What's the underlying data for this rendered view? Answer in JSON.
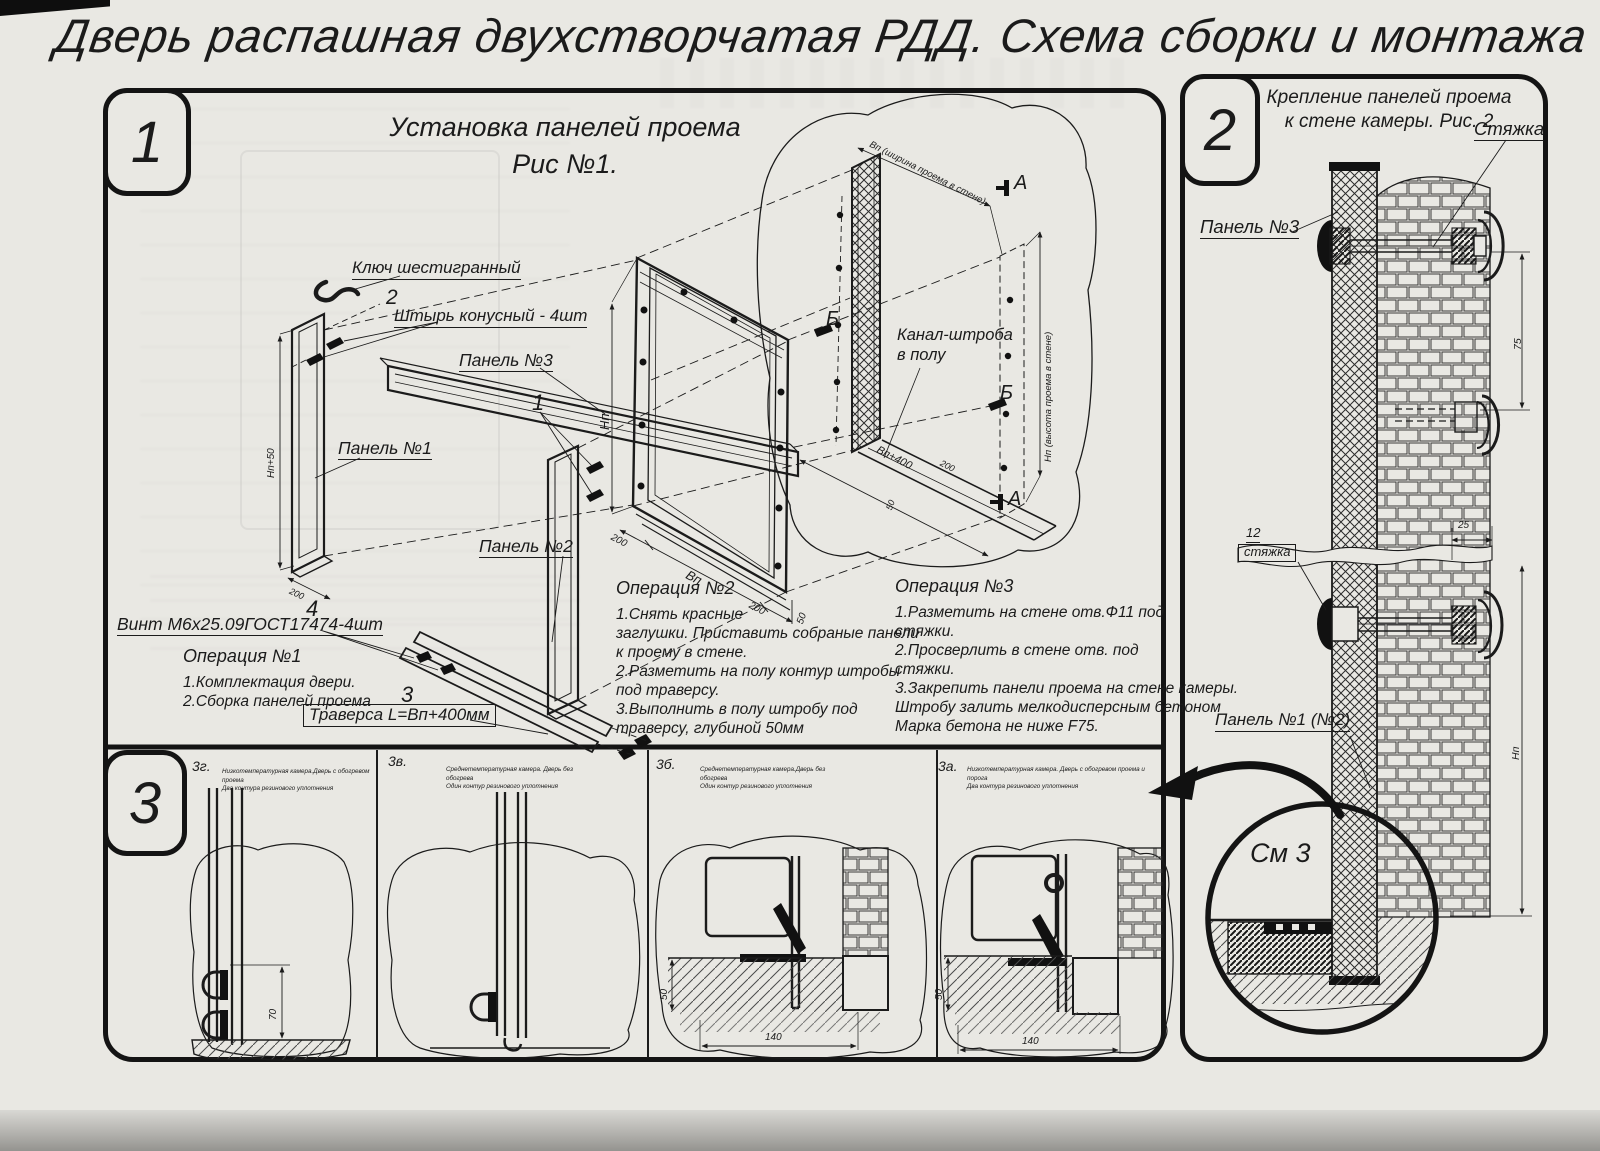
{
  "sheet": {
    "title": "Дверь распашная двухстворчатая РДД.  Схема сборки и монтажа №2"
  },
  "sec1": {
    "badge": "1",
    "fig_title_1": "Установка панелей проема",
    "fig_title_2": "Рис №1.",
    "hex_key": "Ключ шестигранный",
    "pin_no": "2",
    "pin_label": "Штырь конусный - 4шт",
    "panel3": "Панель №3",
    "panel1": "Панель №1",
    "panel2": "Панель №2",
    "no1": "1",
    "no3": "3",
    "no4": "4",
    "screw_label": "Винт М6х25.09ГОСТ17474-4шт",
    "traverse_label": "Траверса  L=Вп+400мм",
    "channel_1": "Канал-штроба",
    "channel_2": "в полу",
    "op1_title": "Операция №1",
    "op1_l1": "1.Комплектация двери.",
    "op1_l2": "2.Сборка панелей проема",
    "op2_title": "Операция №2",
    "op2_l1": "1.Снять красные",
    "op2_l2": "заглушки. Приставить собраные панели",
    "op2_l3": "к проему в стене.",
    "op2_l4": "2.Разметить на полу контур штробы",
    "op2_l5": "под траверсу.",
    "op2_l6": "3.Выполнить в полу штробу под",
    "op2_l7": "траверсу, глубиной 50мм",
    "op3_title": "Операция №3",
    "op3_l1": "1.Разметить на стене отв.Ф11 под",
    "op3_l2": "стяжки.",
    "op3_l3": "2.Просверлить в стене отв.  под",
    "op3_l4": "стяжки.",
    "op3_l5": "3.Закрепить панели проема на стене камеры.",
    "op3_l6": "Штробу залить мелкодисперсным бетоном",
    "op3_l7": "Марка бетона не ниже  F75.",
    "mark_a": "А",
    "mark_b": "Б",
    "dim_np": "Нп",
    "dim_vp": "Вп",
    "dim_np50": "Нп+50",
    "dim_200": "200",
    "dim_50": "50",
    "dim_vp400": "Вп+400",
    "dim_wall_w": "Вп (ширина проема в стене)",
    "dim_wall_h": "Нп (высота проема в стене)"
  },
  "sec2": {
    "badge": "2",
    "fig_title_1": "Крепление панелей проема",
    "fig_title_2": "к стене камеры. Рис. 2",
    "tie_label": "Стяжка",
    "panel3": "Панель №3",
    "tie_no": "12",
    "tie_label2": "стяжка",
    "panel12": "Панель №1 (№2)",
    "see_detail": "См 3",
    "dim_75": "75",
    "dim_25": "25",
    "dim_np": "Нп"
  },
  "sec3": {
    "badge": "3",
    "p1_code": "3г.",
    "p1_d1": "Низкотемпературная камера.Дверь с обогревом проема",
    "p1_d2": "Два контура резинового уплотнения",
    "p1_dim": "70",
    "p2_code": "3в.",
    "p2_d1": "Среднетемпературная камера. Дверь без обогрева",
    "p2_d2": "Один контур резинового уплотнения",
    "p3_code": "3б.",
    "p3_d1": "Среднетемпературная камера.Дверь без обогрева",
    "p3_d2": "Один контур резинового уплотнения",
    "p3_dimv": "50",
    "p3_dimh": "140",
    "p4_code": "3а.",
    "p4_d1": "Низкотемпературная камера. Дверь с обогревом проема и порога",
    "p4_d2": "Два контура резинового уплотнения",
    "p4_dimv": "50",
    "p4_dimh": "140"
  }
}
